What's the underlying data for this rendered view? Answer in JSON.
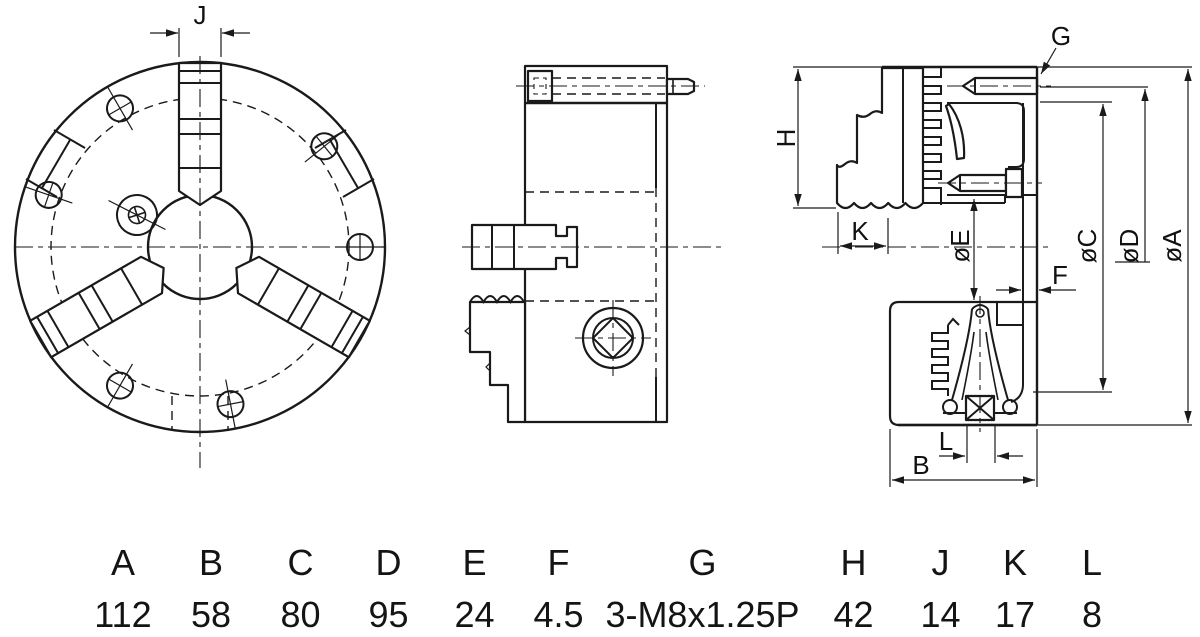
{
  "drawing": {
    "labels": {
      "j": "J",
      "g": "G",
      "h": "H",
      "k": "K",
      "e": "øE",
      "f": "F",
      "c": "øC",
      "d": "øD",
      "a": "øA",
      "b": "B",
      "l": "L"
    }
  },
  "table": {
    "columns": [
      "A",
      "B",
      "C",
      "D",
      "E",
      "F",
      "G",
      "H",
      "J",
      "K",
      "L"
    ],
    "values": [
      "112",
      "58",
      "80",
      "95",
      "24",
      "4.5",
      "3-M8x1.25P",
      "42",
      "14",
      "17",
      "8"
    ]
  }
}
